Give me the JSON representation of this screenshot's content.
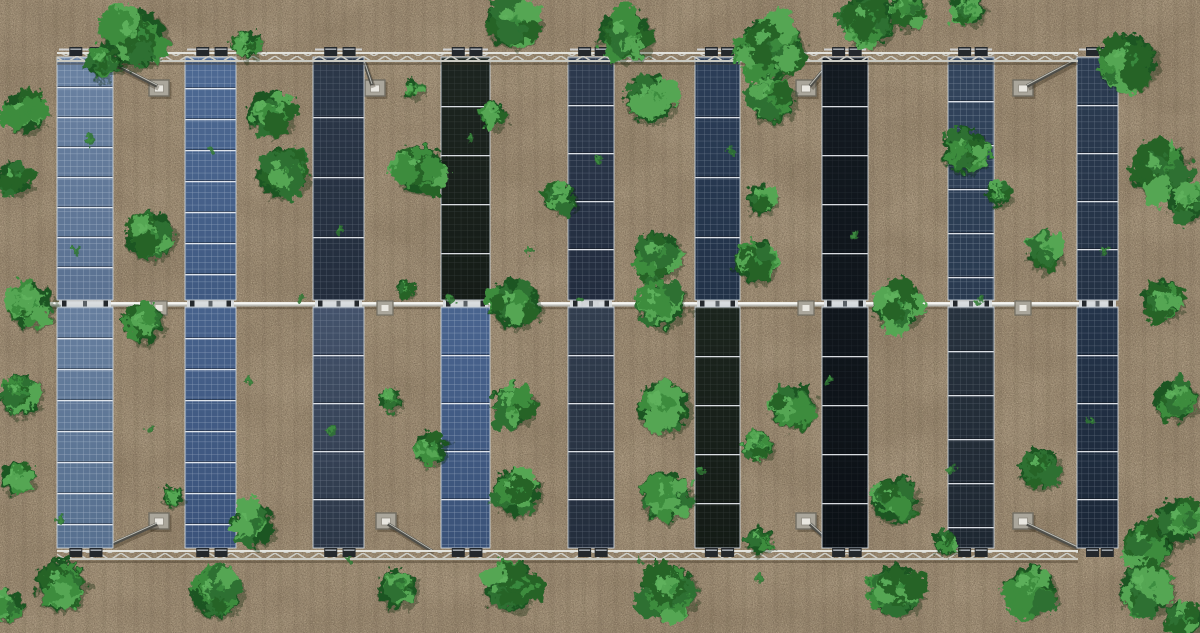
{
  "meta": {
    "description": "Aerial top-down view of an agrivoltaic solar farm: nine vertical rows of solar panels mounted between two horizontal lattice trusses and a central torque tube, over tilled tan soil with scattered green crop bushes growing between the rows",
    "canvas": {
      "width": 1200,
      "height": 633
    }
  },
  "palette": {
    "soil_base": "#a6957c",
    "soil_mottle": "#7c6b55",
    "soil_speck_dark": "#5f5140",
    "soil_speck_light": "#d8c9ab",
    "soil_furrow": "#5a4b38",
    "metal_light": "#e2e2dc",
    "metal_mid": "#c9c9c1",
    "metal_dark": "#8e8e86",
    "truss_web": "#cdcdc6",
    "clamp_dark": "#24282c",
    "clamp_hi": "#aeb4ba",
    "pad_face": "#aaa69b",
    "pad_edge": "#716d62",
    "pad_inner": "#e9e7e0",
    "strut": "#4e4e49",
    "strut_hi": "#bcbcb4",
    "panel_frame": "#cdd5dd",
    "module_line": "#eef2f6",
    "shadow": "rgba(45,35,20,0.32)"
  },
  "structure": {
    "truss": {
      "x1": 57,
      "x2": 1078,
      "top_y": 52,
      "bottom_y": 550,
      "chord_h": 2,
      "web_h": 7
    },
    "tube": {
      "x1": 42,
      "x2": 1114,
      "y": 302,
      "h": 4.6
    },
    "tube_mounts_x": [
      159,
      385,
      590,
      806,
      1023
    ],
    "pads": [
      [
        159,
        88
      ],
      [
        375,
        88
      ],
      [
        806,
        88
      ],
      [
        1023,
        88
      ],
      [
        159,
        521
      ],
      [
        386,
        521
      ],
      [
        806,
        521
      ],
      [
        1023,
        521
      ]
    ],
    "struts": [
      [
        106,
        60,
        157,
        86
      ],
      [
        364,
        61,
        372,
        85
      ],
      [
        831,
        61,
        810,
        86
      ],
      [
        1078,
        59,
        1027,
        86
      ],
      [
        110,
        545,
        157,
        524
      ],
      [
        388,
        524,
        432,
        551
      ],
      [
        810,
        524,
        832,
        544
      ],
      [
        1027,
        524,
        1078,
        548
      ]
    ]
  },
  "panels": {
    "bays": [
      {
        "y": 57,
        "h": 243
      },
      {
        "y": 307,
        "h": 241
      }
    ],
    "columns": [
      {
        "x": 57,
        "w": 56,
        "top": {
          "c1": "#6a82a2",
          "c2": "#5a7191",
          "grid": 0.5,
          "pitch": 30
        },
        "bottom": {
          "c1": "#667e9e",
          "c2": "#57708f",
          "grid": 0.5,
          "pitch": 31
        }
      },
      {
        "x": 185,
        "w": 51,
        "top": {
          "c1": "#4e6a94",
          "c2": "#405a82",
          "grid": 0.45,
          "pitch": 31
        },
        "bottom": {
          "c1": "#47628c",
          "c2": "#3b537b",
          "grid": 0.45,
          "pitch": 31
        }
      },
      {
        "x": 313,
        "w": 51,
        "top": {
          "c1": "#2c3849",
          "c2": "#232d3d",
          "grid": 0.26,
          "pitch": 60
        },
        "bottom": {
          "c1": "#44536c",
          "c2": "#2b3646",
          "grid": 0.3,
          "pitch": 48
        }
      },
      {
        "x": 441,
        "w": 49,
        "top": {
          "c1": "#1d2520",
          "c2": "#151c17",
          "grid": 0.14,
          "pitch": 49
        },
        "bottom": {
          "c1": "#49648f",
          "c2": "#3a5278",
          "grid": 0.46,
          "pitch": 48
        }
      },
      {
        "x": 568,
        "w": 46,
        "top": {
          "c1": "#2d3a4e",
          "c2": "#222c3e",
          "grid": 0.3,
          "pitch": 48
        },
        "bottom": {
          "c1": "#323e4f",
          "c2": "#232d3c",
          "grid": 0.26,
          "pitch": 48
        }
      },
      {
        "x": 695,
        "w": 45,
        "top": {
          "c1": "#2c3e58",
          "c2": "#223248",
          "grid": 0.34,
          "pitch": 60
        },
        "bottom": {
          "c1": "#1b241d",
          "c2": "#141b16",
          "grid": 0.14,
          "pitch": 49
        }
      },
      {
        "x": 822,
        "w": 46,
        "top": {
          "c1": "#131a21",
          "c2": "#0f151b",
          "grid": 0.1,
          "pitch": 49
        },
        "bottom": {
          "c1": "#10161c",
          "c2": "#0c1116",
          "grid": 0.09,
          "pitch": 49
        }
      },
      {
        "x": 948,
        "w": 46,
        "top": {
          "c1": "#33455d",
          "c2": "#293a50",
          "grid": 0.4,
          "pitch": 44
        },
        "bottom": {
          "c1": "#27323e",
          "c2": "#1e2731",
          "grid": 0.24,
          "pitch": 44
        }
      },
      {
        "x": 1077,
        "w": 41,
        "top": {
          "c1": "#2c3c52",
          "c2": "#233144",
          "grid": 0.32,
          "pitch": 48
        },
        "bottom": {
          "c1": "#24344a",
          "c2": "#1b2737",
          "grid": 0.3,
          "pitch": 48
        }
      }
    ]
  },
  "vegetation": {
    "bush_colors": [
      "#1e5423",
      "#2d7031",
      "#256428",
      "#3c8c3e",
      "#54a653",
      "#5fb35d"
    ],
    "bushes": [
      [
        135,
        38,
        32
      ],
      [
        104,
        62,
        18
      ],
      [
        247,
        44,
        15
      ],
      [
        512,
        22,
        28
      ],
      [
        625,
        35,
        28
      ],
      [
        650,
        98,
        26
      ],
      [
        770,
        48,
        34
      ],
      [
        772,
        100,
        24
      ],
      [
        868,
        20,
        28
      ],
      [
        905,
        10,
        20
      ],
      [
        968,
        9,
        18
      ],
      [
        1128,
        62,
        30
      ],
      [
        413,
        88,
        10
      ],
      [
        493,
        115,
        14
      ],
      [
        24,
        112,
        22
      ],
      [
        14,
        178,
        18
      ],
      [
        30,
        305,
        24
      ],
      [
        20,
        395,
        22
      ],
      [
        17,
        478,
        17
      ],
      [
        270,
        112,
        24
      ],
      [
        282,
        172,
        27
      ],
      [
        420,
        170,
        26
      ],
      [
        560,
        197,
        17
      ],
      [
        657,
        255,
        25
      ],
      [
        761,
        199,
        16
      ],
      [
        755,
        262,
        22
      ],
      [
        999,
        194,
        13
      ],
      [
        965,
        150,
        24
      ],
      [
        1160,
        170,
        30
      ],
      [
        1186,
        202,
        20
      ],
      [
        150,
        235,
        26
      ],
      [
        143,
        323,
        21
      ],
      [
        405,
        288,
        10
      ],
      [
        515,
        303,
        26
      ],
      [
        661,
        303,
        26
      ],
      [
        897,
        305,
        26
      ],
      [
        1162,
        300,
        22
      ],
      [
        1045,
        252,
        20
      ],
      [
        390,
        400,
        12
      ],
      [
        430,
        448,
        18
      ],
      [
        513,
        405,
        23
      ],
      [
        516,
        492,
        25
      ],
      [
        663,
        407,
        28
      ],
      [
        666,
        496,
        27
      ],
      [
        757,
        445,
        16
      ],
      [
        758,
        540,
        14
      ],
      [
        793,
        406,
        24
      ],
      [
        1040,
        468,
        22
      ],
      [
        1175,
        400,
        22
      ],
      [
        894,
        499,
        25
      ],
      [
        945,
        542,
        13
      ],
      [
        172,
        496,
        11
      ],
      [
        253,
        524,
        22
      ],
      [
        1147,
        545,
        26
      ],
      [
        1180,
        520,
        24
      ],
      [
        60,
        585,
        27
      ],
      [
        216,
        592,
        27
      ],
      [
        397,
        588,
        21
      ],
      [
        510,
        586,
        27
      ],
      [
        668,
        591,
        29
      ],
      [
        895,
        590,
        28
      ],
      [
        1030,
        590,
        27
      ],
      [
        1146,
        589,
        28
      ],
      [
        1183,
        620,
        20
      ],
      [
        8,
        605,
        16
      ]
    ],
    "weeds": [
      [
        90,
        140,
        3
      ],
      [
        210,
        150,
        2
      ],
      [
        340,
        230,
        3
      ],
      [
        470,
        140,
        2
      ],
      [
        600,
        160,
        3
      ],
      [
        730,
        150,
        2
      ],
      [
        855,
        235,
        3
      ],
      [
        980,
        300,
        2
      ],
      [
        1105,
        250,
        3
      ],
      [
        75,
        250,
        2
      ],
      [
        330,
        430,
        3
      ],
      [
        580,
        300,
        2
      ],
      [
        700,
        470,
        3
      ],
      [
        830,
        380,
        2
      ],
      [
        950,
        470,
        3
      ],
      [
        1090,
        420,
        2
      ],
      [
        250,
        380,
        3
      ],
      [
        150,
        430,
        2
      ],
      [
        60,
        520,
        3
      ],
      [
        300,
        300,
        2
      ],
      [
        530,
        250,
        3
      ],
      [
        640,
        560,
        2
      ],
      [
        760,
        580,
        3
      ],
      [
        350,
        560,
        2
      ],
      [
        450,
        300,
        3
      ]
    ]
  }
}
